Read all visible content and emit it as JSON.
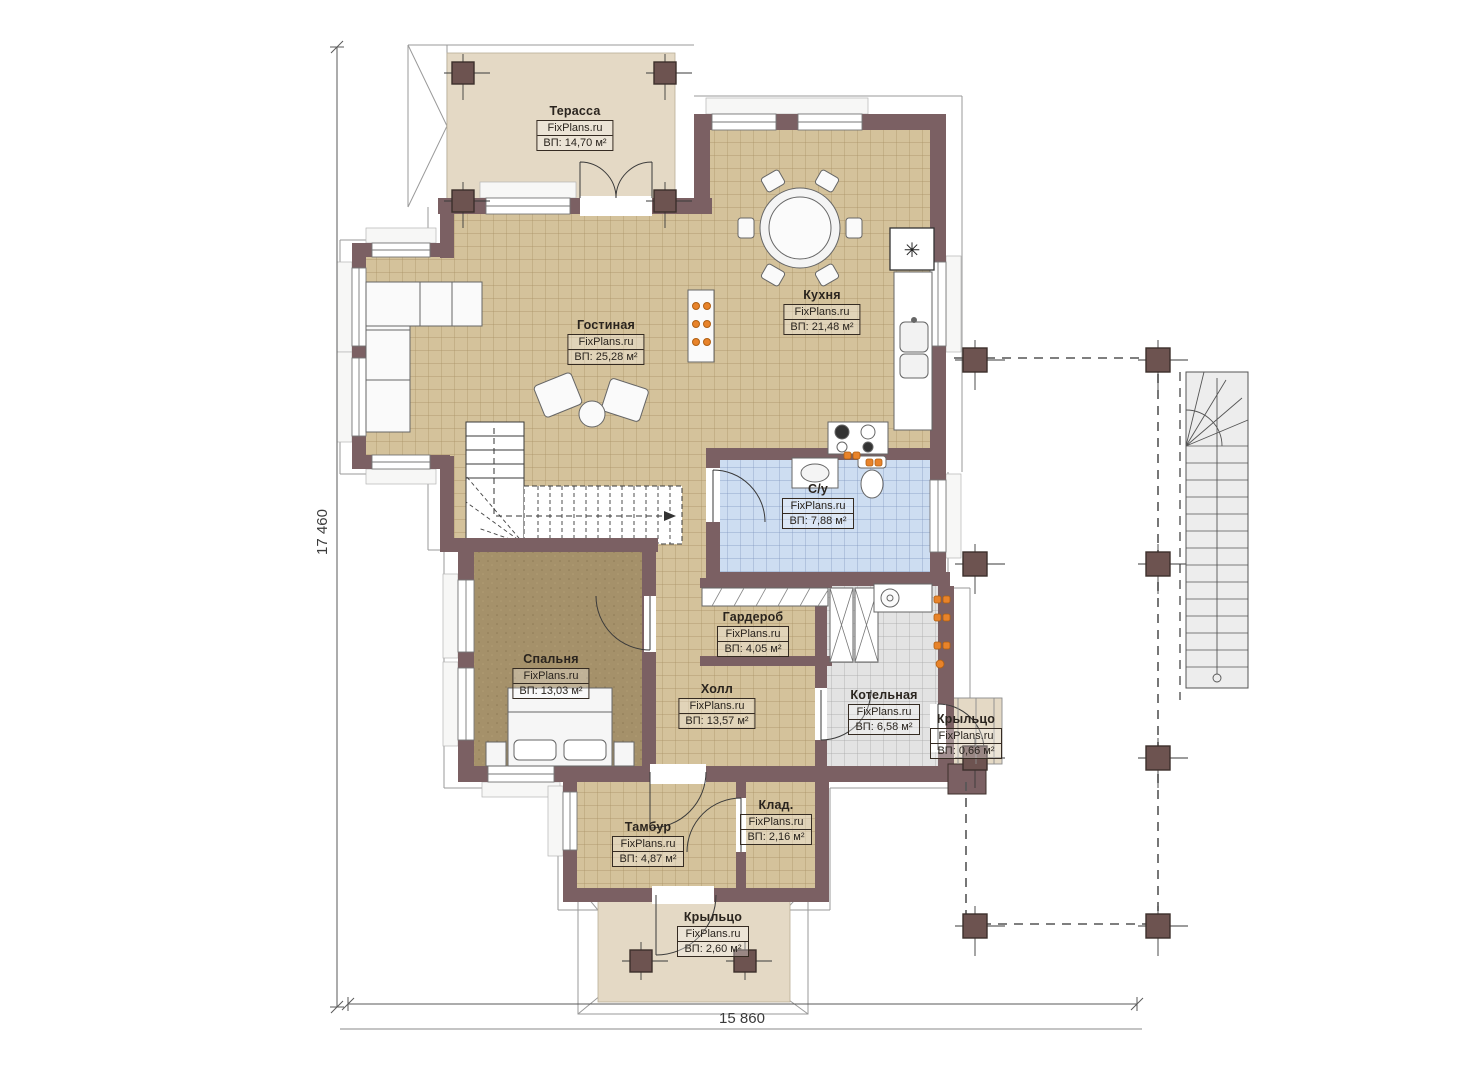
{
  "plan": {
    "brand": "FixPlans.ru",
    "dimensions": {
      "left_vertical": "17 460",
      "bottom_horizontal": "15 860"
    },
    "rooms": [
      {
        "id": "terrace",
        "name": "Терасса",
        "brand": "FixPlans.ru",
        "area": "ВП: 14,70 м²"
      },
      {
        "id": "kitchen",
        "name": "Кухня",
        "brand": "FixPlans.ru",
        "area": "ВП: 21,48 м²"
      },
      {
        "id": "living",
        "name": "Гостиная",
        "brand": "FixPlans.ru",
        "area": "ВП: 25,28 м²"
      },
      {
        "id": "bathroom",
        "name": "С/у",
        "brand": "FixPlans.ru",
        "area": "ВП: 7,88 м²"
      },
      {
        "id": "wardrobe",
        "name": "Гардероб",
        "brand": "FixPlans.ru",
        "area": "ВП: 4,05 м²"
      },
      {
        "id": "bedroom",
        "name": "Спальня",
        "brand": "FixPlans.ru",
        "area": "ВП: 13,03 м²"
      },
      {
        "id": "hall",
        "name": "Холл",
        "brand": "FixPlans.ru",
        "area": "ВП: 13,57 м²"
      },
      {
        "id": "boiler",
        "name": "Котельная",
        "brand": "FixPlans.ru",
        "area": "ВП: 6,58 м²"
      },
      {
        "id": "porch-right",
        "name": "Крыльцо",
        "brand": "FixPlans.ru",
        "area": "ВП: 0,66 м²"
      },
      {
        "id": "vestibule",
        "name": "Тамбур",
        "brand": "FixPlans.ru",
        "area": "ВП: 4,87 м²"
      },
      {
        "id": "storage",
        "name": "Клад.",
        "brand": "FixPlans.ru",
        "area": "ВП: 2,16 м²"
      },
      {
        "id": "porch-bottom",
        "name": "Крыльцо",
        "brand": "FixPlans.ru",
        "area": "ВП: 2,60 м²"
      }
    ],
    "icons": {
      "chimney_flue": "✳"
    },
    "colors": {
      "wall": "#7b6063",
      "column": "#6d5350",
      "floor_tile_tan": "#d4c29b",
      "terrace_beige": "#e4d9c5",
      "bedroom_olive": "#a5916a",
      "bathroom_blue": "#cdddf1",
      "boiler_gray": "#e3e3e3",
      "radiator_orange": "#e8832a",
      "outline_gray": "#9a9a9a"
    }
  }
}
